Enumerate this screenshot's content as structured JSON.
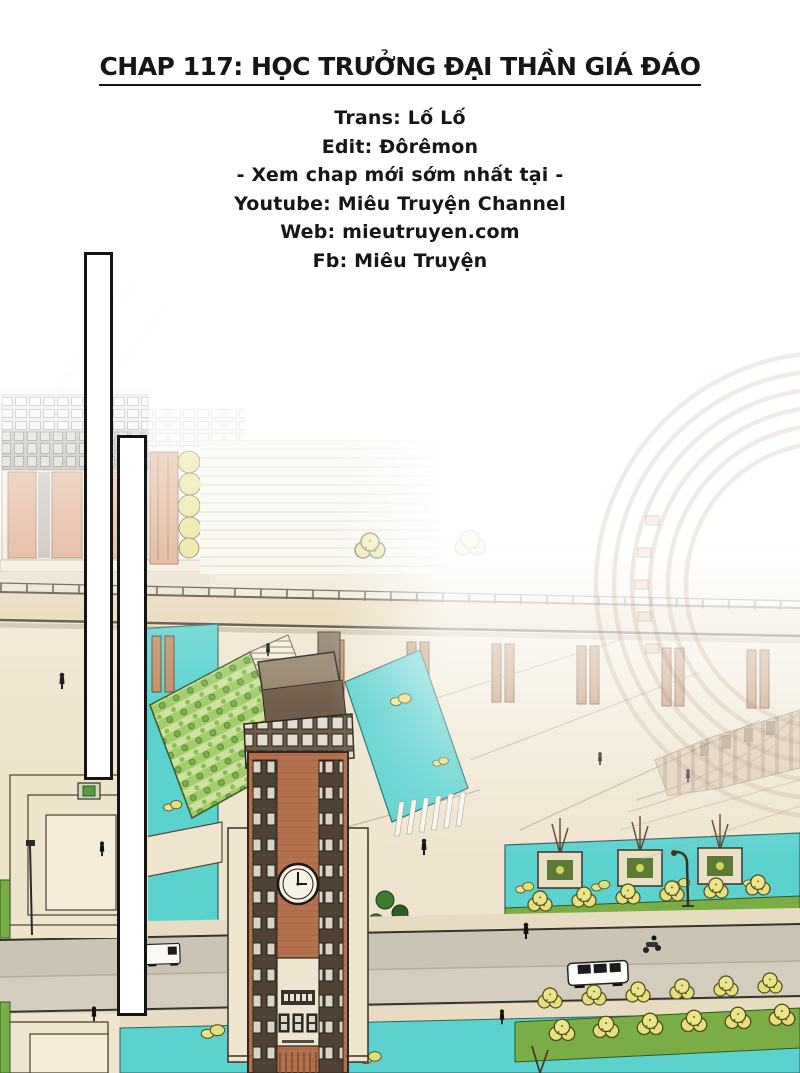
{
  "header": {
    "chapter_title": "CHAP 117: HỌC TRƯỞNG ĐẠI THẦN GIÁ ĐÁO",
    "credits": [
      "Trans: Lố Lố",
      "Edit: Đôrêmon",
      "- Xem chap mới sớm nhất tại -",
      "Youtube: Miêu Truyện Channel",
      "Web: mieutruyen.com",
      "Fb: Miêu Truyện"
    ]
  },
  "colors": {
    "ink": "#161616",
    "water_teal": "#5cd2cf",
    "brick": "#b5714e",
    "plaza_beige": "#efe5cf",
    "hedge_green": "#7aad45",
    "garden_light_green": "#cde2a0",
    "tree_yellow": "#e7df7d",
    "road_gray": "#cbc4b4",
    "facade_orange": "#d9a07b",
    "roof_brown": "#6e5d4a"
  }
}
